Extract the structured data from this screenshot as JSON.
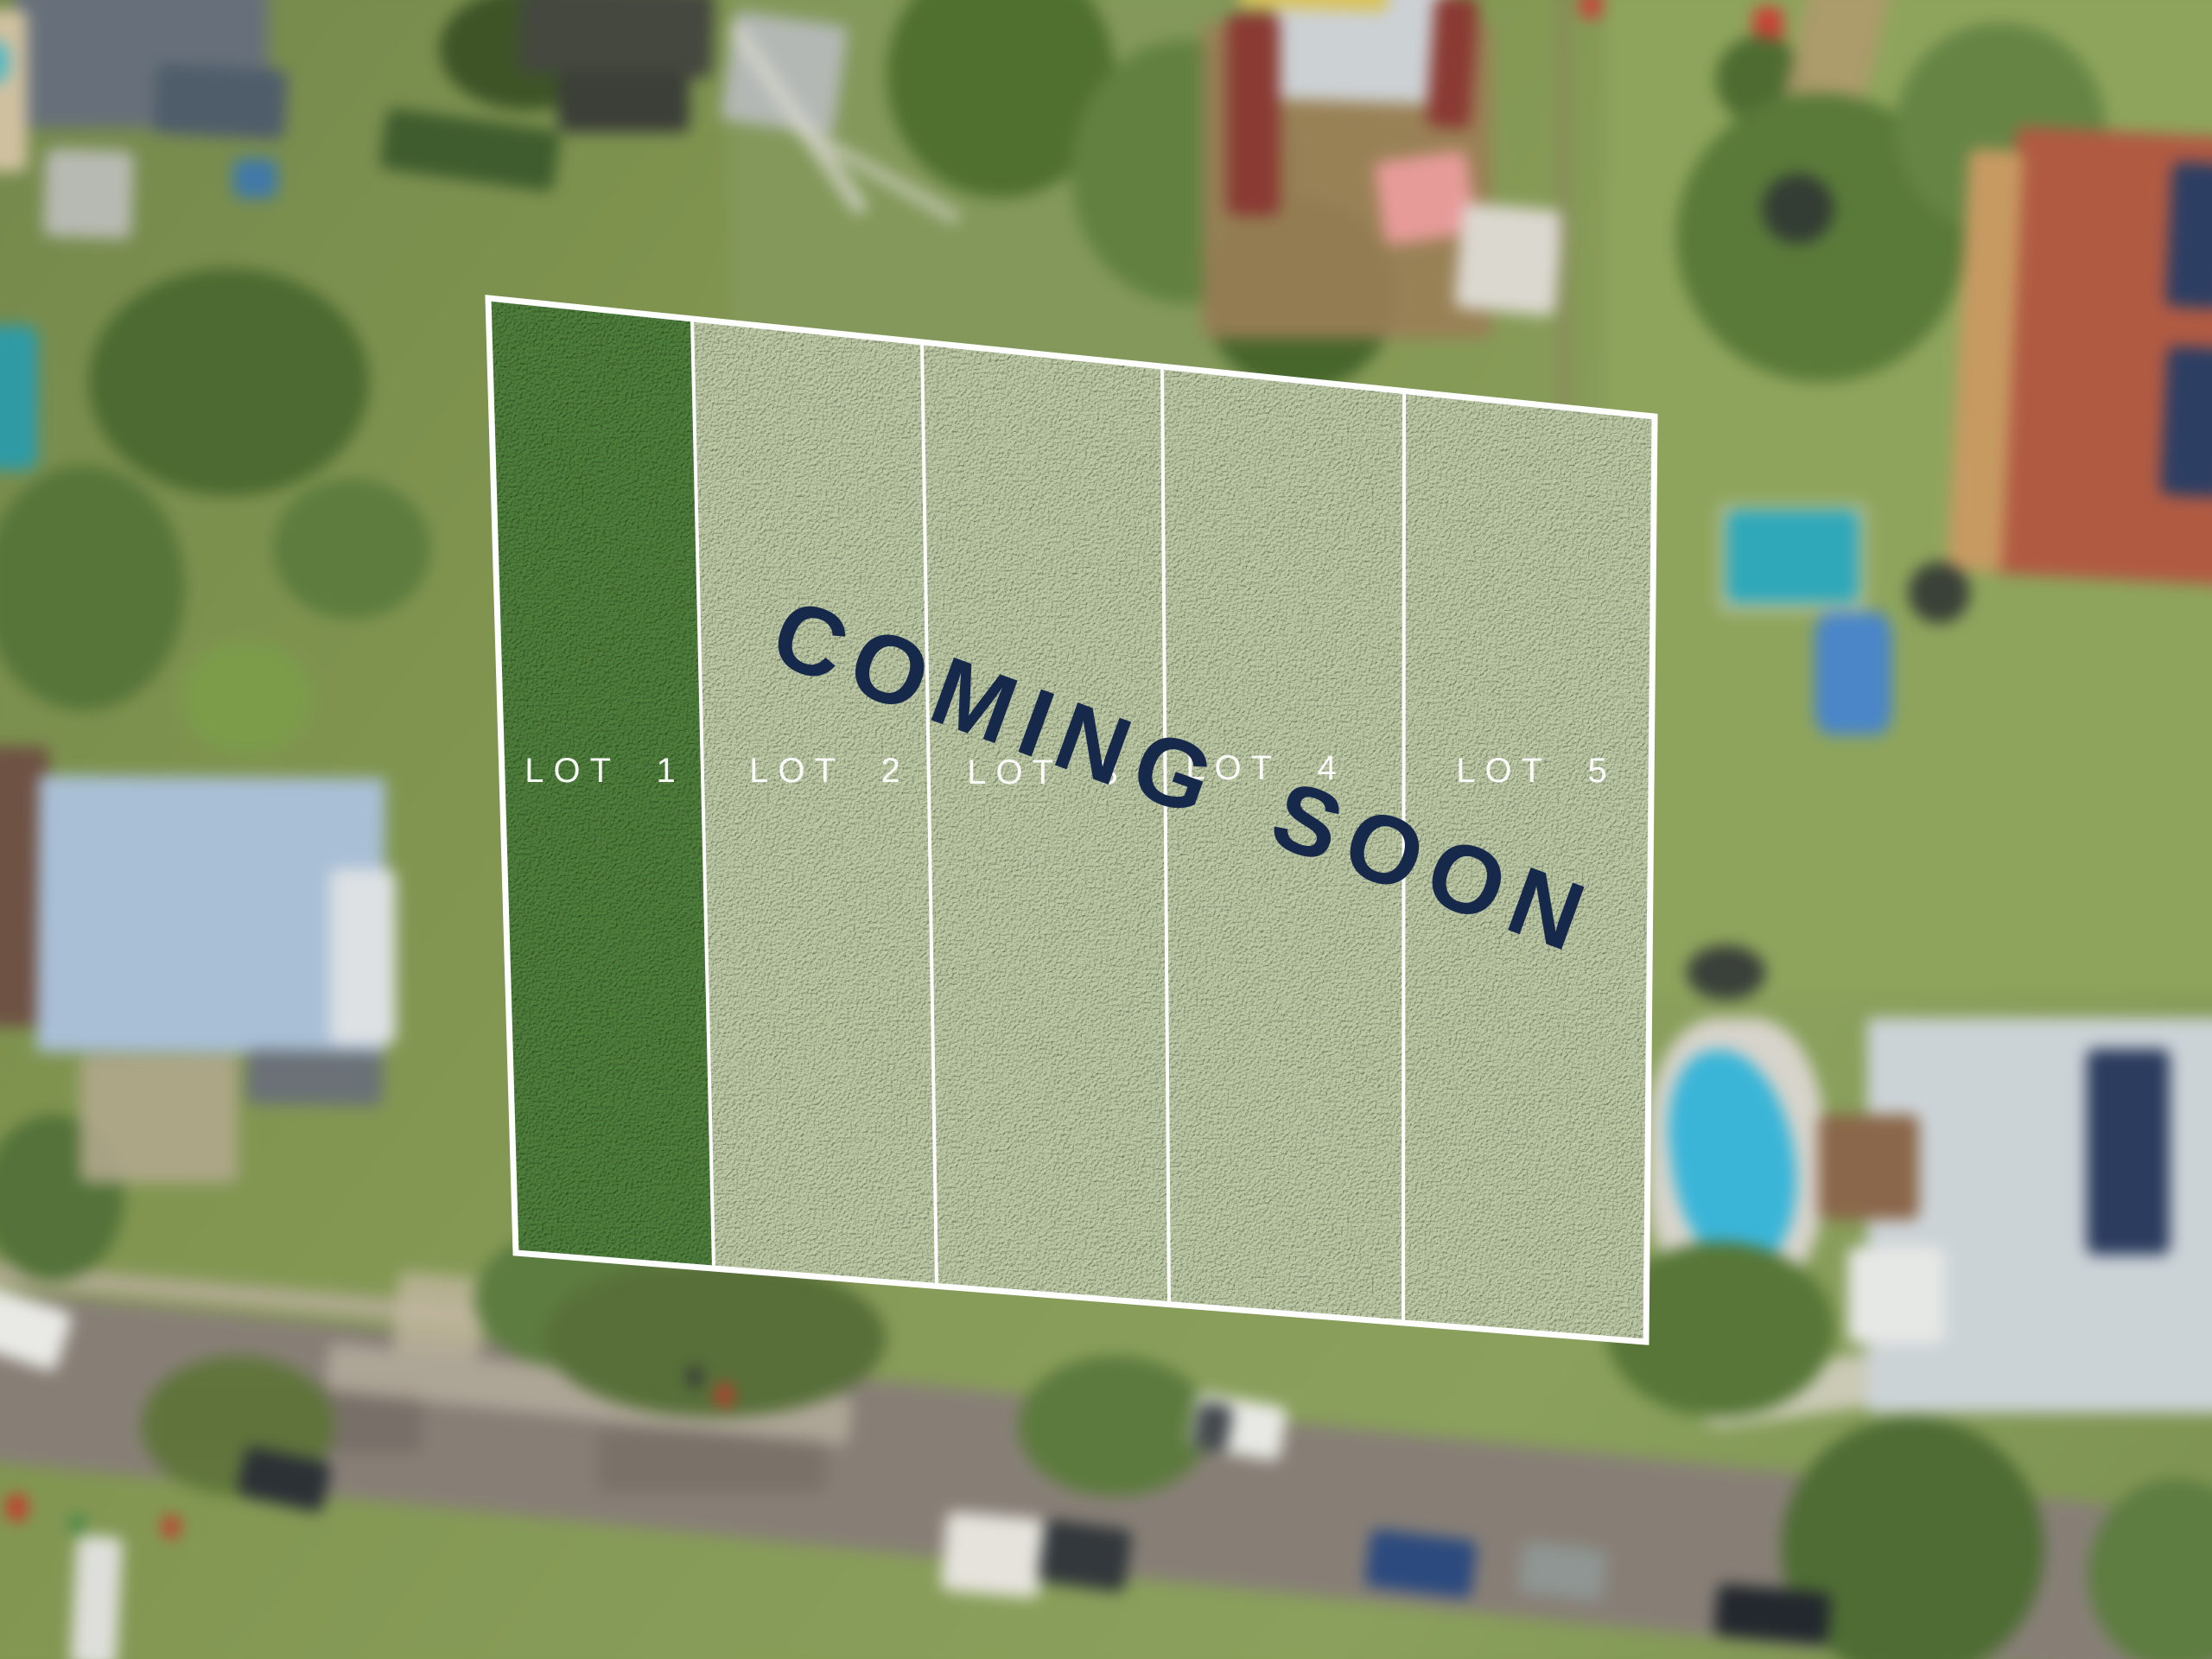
{
  "overlay": {
    "coming_soon": "COMING SOON",
    "lots": [
      {
        "label": "LOT 1"
      },
      {
        "label": "LOT 2"
      },
      {
        "label": "LOT 3"
      },
      {
        "label": "LOT 4"
      },
      {
        "label": "LOT 5"
      }
    ]
  },
  "colors": {
    "coming_soon_navy": "#16294b",
    "lot1_grass": "#4f7f3c",
    "available_lot_grass": "#bdcaa5",
    "boundary_white": "#ffffff"
  }
}
